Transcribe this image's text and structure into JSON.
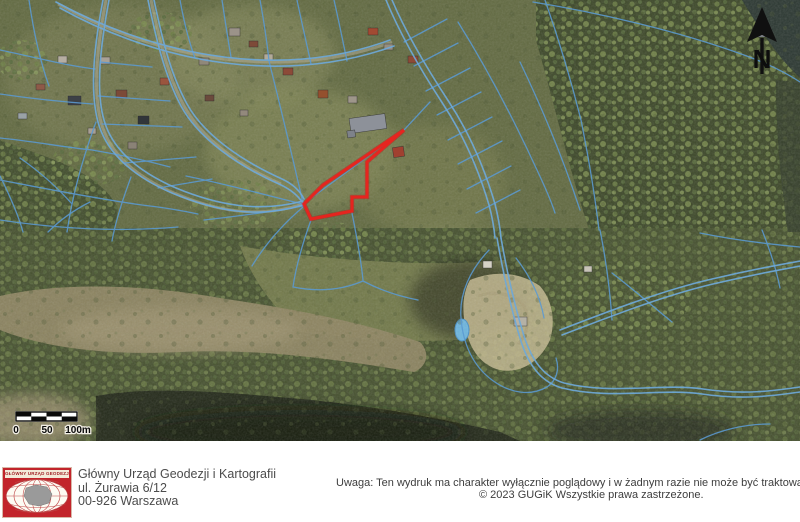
{
  "map": {
    "coordinates_label": "322921,60  702409,64",
    "north_label": "N",
    "scale_bar": {
      "label_0": "0",
      "label_50": "50",
      "label_100": "100m"
    },
    "red_parcel": {
      "points": "404,130 367,162 367,197 352,197 352,211 311,219 304,204 323,185",
      "color": "#e8231e"
    },
    "colors": {
      "cadastral_line": "#5b9ad2",
      "road_line": "#6ea9d9",
      "water": "#6db5dd"
    }
  },
  "footer": {
    "logo_band_text": "GŁÓWNY URZĄD GEODEZJI I KARTOGRAFII",
    "org_name": "Główny Urząd Geodezji i Kartografii",
    "address_line1": "ul. Żurawia 6/12",
    "address_line2": "00-926 Warszawa",
    "notice": "Uwaga: Ten wydruk ma charakter wyłącznie poglądowy i w żadnym razie nie może być traktowany jako dokument oficjalny",
    "copyright": "© 2023 GUGiK Wszystkie prawa zastrzeżone."
  }
}
